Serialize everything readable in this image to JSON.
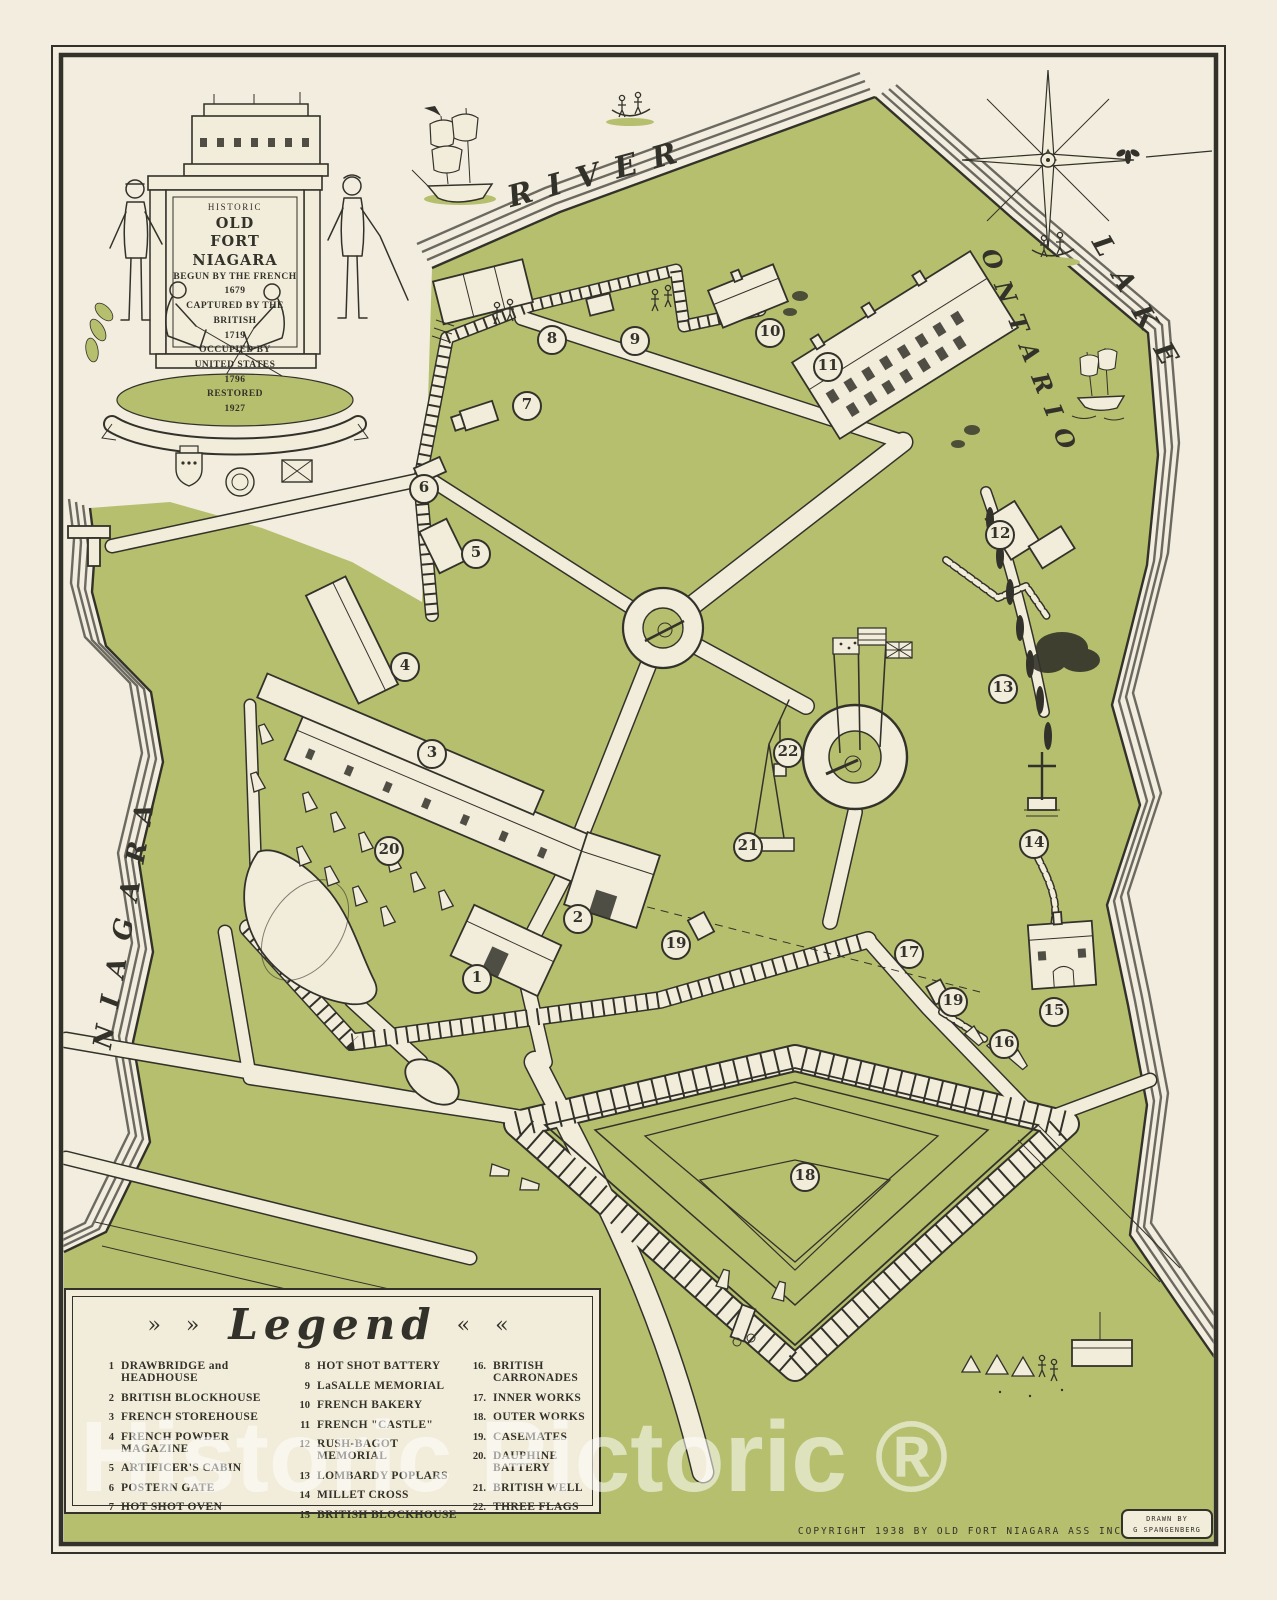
{
  "colors": {
    "paper": "#f2eddf",
    "green": "#b5bf6e",
    "ink": "#33322a",
    "road": "#f2ecda",
    "watermark": "rgba(255,255,255,0.55)"
  },
  "cartouche": {
    "historic": "HISTORIC",
    "old": "OLD",
    "name": "FORT NIAGARA",
    "began": "BEGUN BY THE FRENCH",
    "began_year": "1679",
    "captured": "CAPTURED BY THE BRITISH",
    "captured_year": "1719",
    "occupied1": "OCCUPIED BY",
    "occupied2": "UNITED STATES",
    "occupied_year": "1796",
    "restored": "RESTORED",
    "restored_year": "1927"
  },
  "water_labels": {
    "river": "RIVER",
    "lake": "LAKE",
    "ontario": "ONTARIO",
    "niagara": "NIAGARA"
  },
  "markers": [
    {
      "n": "1",
      "x": 477,
      "y": 979
    },
    {
      "n": "2",
      "x": 578,
      "y": 919
    },
    {
      "n": "3",
      "x": 432,
      "y": 754
    },
    {
      "n": "4",
      "x": 405,
      "y": 667
    },
    {
      "n": "5",
      "x": 476,
      "y": 554
    },
    {
      "n": "6",
      "x": 424,
      "y": 489
    },
    {
      "n": "7",
      "x": 527,
      "y": 406
    },
    {
      "n": "8",
      "x": 552,
      "y": 340
    },
    {
      "n": "9",
      "x": 635,
      "y": 341
    },
    {
      "n": "10",
      "x": 770,
      "y": 333
    },
    {
      "n": "11",
      "x": 828,
      "y": 367
    },
    {
      "n": "12",
      "x": 1000,
      "y": 535
    },
    {
      "n": "13",
      "x": 1003,
      "y": 689
    },
    {
      "n": "14",
      "x": 1034,
      "y": 844
    },
    {
      "n": "15",
      "x": 1054,
      "y": 1012
    },
    {
      "n": "16",
      "x": 1004,
      "y": 1044
    },
    {
      "n": "17",
      "x": 909,
      "y": 954
    },
    {
      "n": "18",
      "x": 805,
      "y": 1177
    },
    {
      "n": "19",
      "x": 676,
      "y": 945
    },
    {
      "n": "19",
      "x": 953,
      "y": 1002
    },
    {
      "n": "20",
      "x": 389,
      "y": 851
    },
    {
      "n": "21",
      "x": 748,
      "y": 847
    },
    {
      "n": "22",
      "x": 788,
      "y": 753
    }
  ],
  "legend": {
    "prefix": "» »",
    "title": "Legend",
    "suffix": "« «",
    "columns": [
      [
        {
          "num": "1",
          "label": "DRAWBRIDGE and HEADHOUSE"
        },
        {
          "num": "2",
          "label": "BRITISH BLOCKHOUSE"
        },
        {
          "num": "3",
          "label": "FRENCH STOREHOUSE"
        },
        {
          "num": "4",
          "label": "FRENCH POWDER MAGAZINE"
        },
        {
          "num": "5",
          "label": "ARTIFICER'S CABIN"
        },
        {
          "num": "6",
          "label": "POSTERN GATE"
        },
        {
          "num": "7",
          "label": "HOT SHOT OVEN"
        }
      ],
      [
        {
          "num": "8",
          "label": "HOT SHOT BATTERY"
        },
        {
          "num": "9",
          "label": "LaSALLE MEMORIAL"
        },
        {
          "num": "10",
          "label": "FRENCH BAKERY"
        },
        {
          "num": "11",
          "label": "FRENCH \"CASTLE\""
        },
        {
          "num": "12",
          "label": "RUSH-BAGOT MEMORIAL"
        },
        {
          "num": "13",
          "label": "LOMBARDY POPLARS"
        },
        {
          "num": "14",
          "label": "MILLET CROSS"
        },
        {
          "num": "15",
          "label": "BRITISH BLOCKHOUSE"
        }
      ],
      [
        {
          "num": "16.",
          "label": "BRITISH CARRONADES"
        },
        {
          "num": "17.",
          "label": "INNER WORKS"
        },
        {
          "num": "18.",
          "label": "OUTER WORKS"
        },
        {
          "num": "19.",
          "label": "CASEMATES"
        },
        {
          "num": "20.",
          "label": "DAUPHINE BATTERY"
        },
        {
          "num": "21.",
          "label": "BRITISH WELL"
        },
        {
          "num": "22.",
          "label": "THREE FLAGS"
        }
      ]
    ]
  },
  "footer": {
    "copyright": "COPYRIGHT 1938 BY OLD FORT NIAGARA ASS INC",
    "drawn_by": [
      "DRAWN BY",
      "G SPANGENBERG"
    ]
  },
  "watermark": "Historic Pictoric ®"
}
